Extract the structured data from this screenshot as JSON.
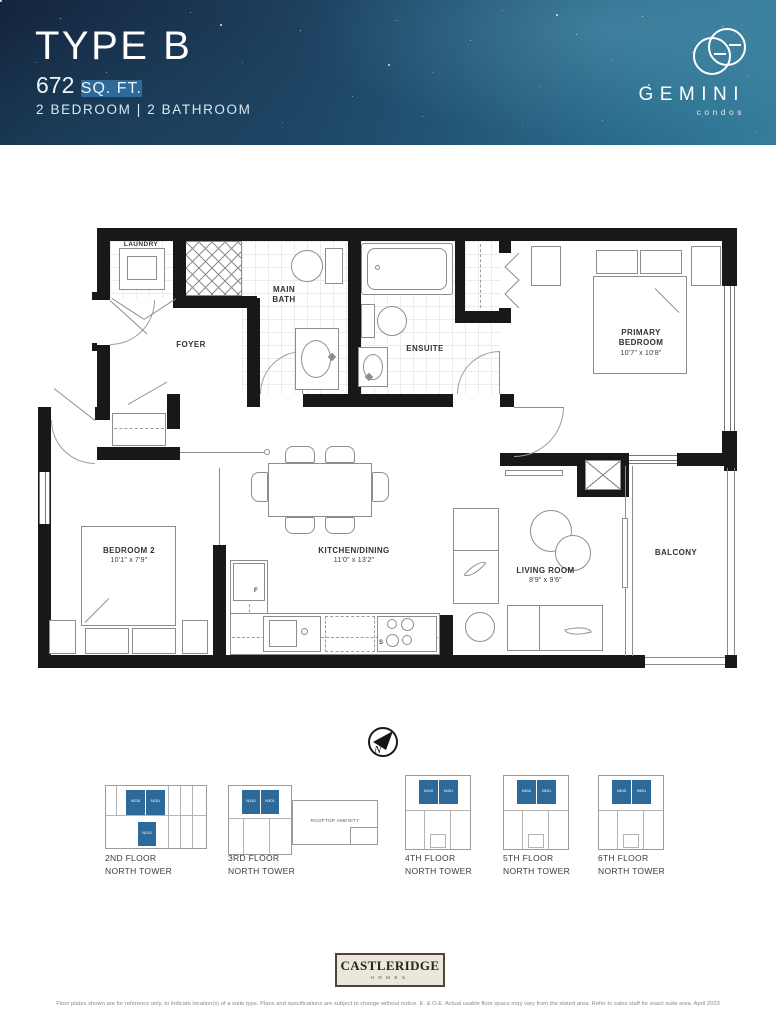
{
  "header": {
    "plan_type": "TYPE B",
    "area": "672",
    "area_unit": "SQ. FT.",
    "config": "2 BEDROOM | 2 BATHROOM",
    "brand_name": "GEMINI",
    "brand_sub": "condos"
  },
  "plan": {
    "laundry": "LAUNDRY",
    "main_bath_1": "MAIN",
    "main_bath_2": "BATH",
    "ensuite": "ENSUITE",
    "foyer": "FOYER",
    "primary_1": "PRIMARY",
    "primary_2": "BEDROOM",
    "primary_dims": "10'7\" x 10'8\"",
    "bedroom2": "BEDROOM 2",
    "bedroom2_dims": "10'1\" x 7'9\"",
    "kitchen": "KITCHEN/DINING",
    "kitchen_dims": "11'0\" x 13'2\"",
    "living": "LIVING ROOM",
    "living_dims": "8'9\" x 9'6\"",
    "balcony": "BALCONY",
    "fridge": "F",
    "stove": "S",
    "compass": "N"
  },
  "locators": {
    "rooftop": "ROOFTOP AMENITY",
    "floors": [
      {
        "line1": "2ND FLOOR",
        "line2": "NORTH TOWER",
        "unit_a": "N215",
        "unit_b": "N201",
        "unit_c": "N210"
      },
      {
        "line1": "3RD FLOOR",
        "line2": "NORTH TOWER",
        "unit_a": "N310",
        "unit_b": "N301"
      },
      {
        "line1": "4TH FLOOR",
        "line2": "NORTH TOWER",
        "unit_a": "N410",
        "unit_b": "N401"
      },
      {
        "line1": "5TH FLOOR",
        "line2": "NORTH TOWER",
        "unit_a": "N510",
        "unit_b": "N501"
      },
      {
        "line1": "6TH FLOOR",
        "line2": "NORTH TOWER",
        "unit_a": "N610",
        "unit_b": "N601"
      }
    ]
  },
  "builder": {
    "name": "CASTLERIDGE",
    "sub": "HOMES"
  },
  "disclaimer": "Floor plates shown are for reference only, to indicate location(s) of a suite type. Plans and specifications are subject to change without notice. E. & O.E. Actual usable floor space may vary from the stated area. Refer to sales staff for exact suite area. April 2023",
  "colors": {
    "highlight": "#2d6a99",
    "header_deep": "#14243c",
    "header_teal": "#357d9b"
  }
}
